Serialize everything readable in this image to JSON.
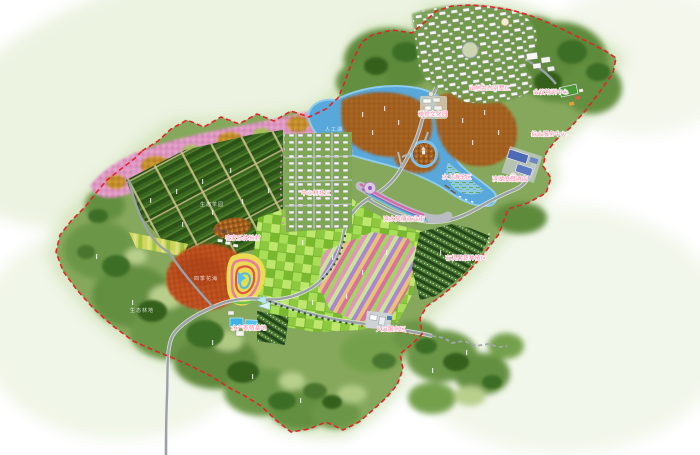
{
  "map": {
    "boundary_color": "#e42328",
    "label_color": "#ff7fa2",
    "lake_color": "#58a8dc",
    "farmland_color": "#8cc93e",
    "orchard_color": "#9c5a1e",
    "forest_color": "#5d8a3a",
    "labels": [
      {
        "text": "山地生态别墅区",
        "x": 490,
        "y": 90
      },
      {
        "text": "会议培训中心",
        "x": 551,
        "y": 94
      },
      {
        "text": "禅修文化园",
        "x": 433,
        "y": 116
      },
      {
        "text": "综合服务中心",
        "x": 549,
        "y": 136
      },
      {
        "text": "水上游乐区",
        "x": 457,
        "y": 179
      },
      {
        "text": "滨湖度假酒店",
        "x": 510,
        "y": 181
      },
      {
        "text": "滨水风情商业街",
        "x": 404,
        "y": 221
      },
      {
        "text": "中心村社区",
        "x": 316,
        "y": 195
      },
      {
        "text": "农家乐体验村",
        "x": 243,
        "y": 240
      },
      {
        "text": "有机果蔬种植区",
        "x": 466,
        "y": 260
      },
      {
        "text": "水产养殖基地",
        "x": 249,
        "y": 330
      },
      {
        "text": "入口服务区",
        "x": 391,
        "y": 331
      }
    ],
    "area_labels": [
      {
        "text": "人工湖",
        "x": 334,
        "y": 131
      },
      {
        "text": "生态茶园",
        "x": 212,
        "y": 206
      },
      {
        "text": "四季花海",
        "x": 206,
        "y": 280
      },
      {
        "text": "生态林地",
        "x": 142,
        "y": 312
      }
    ]
  }
}
